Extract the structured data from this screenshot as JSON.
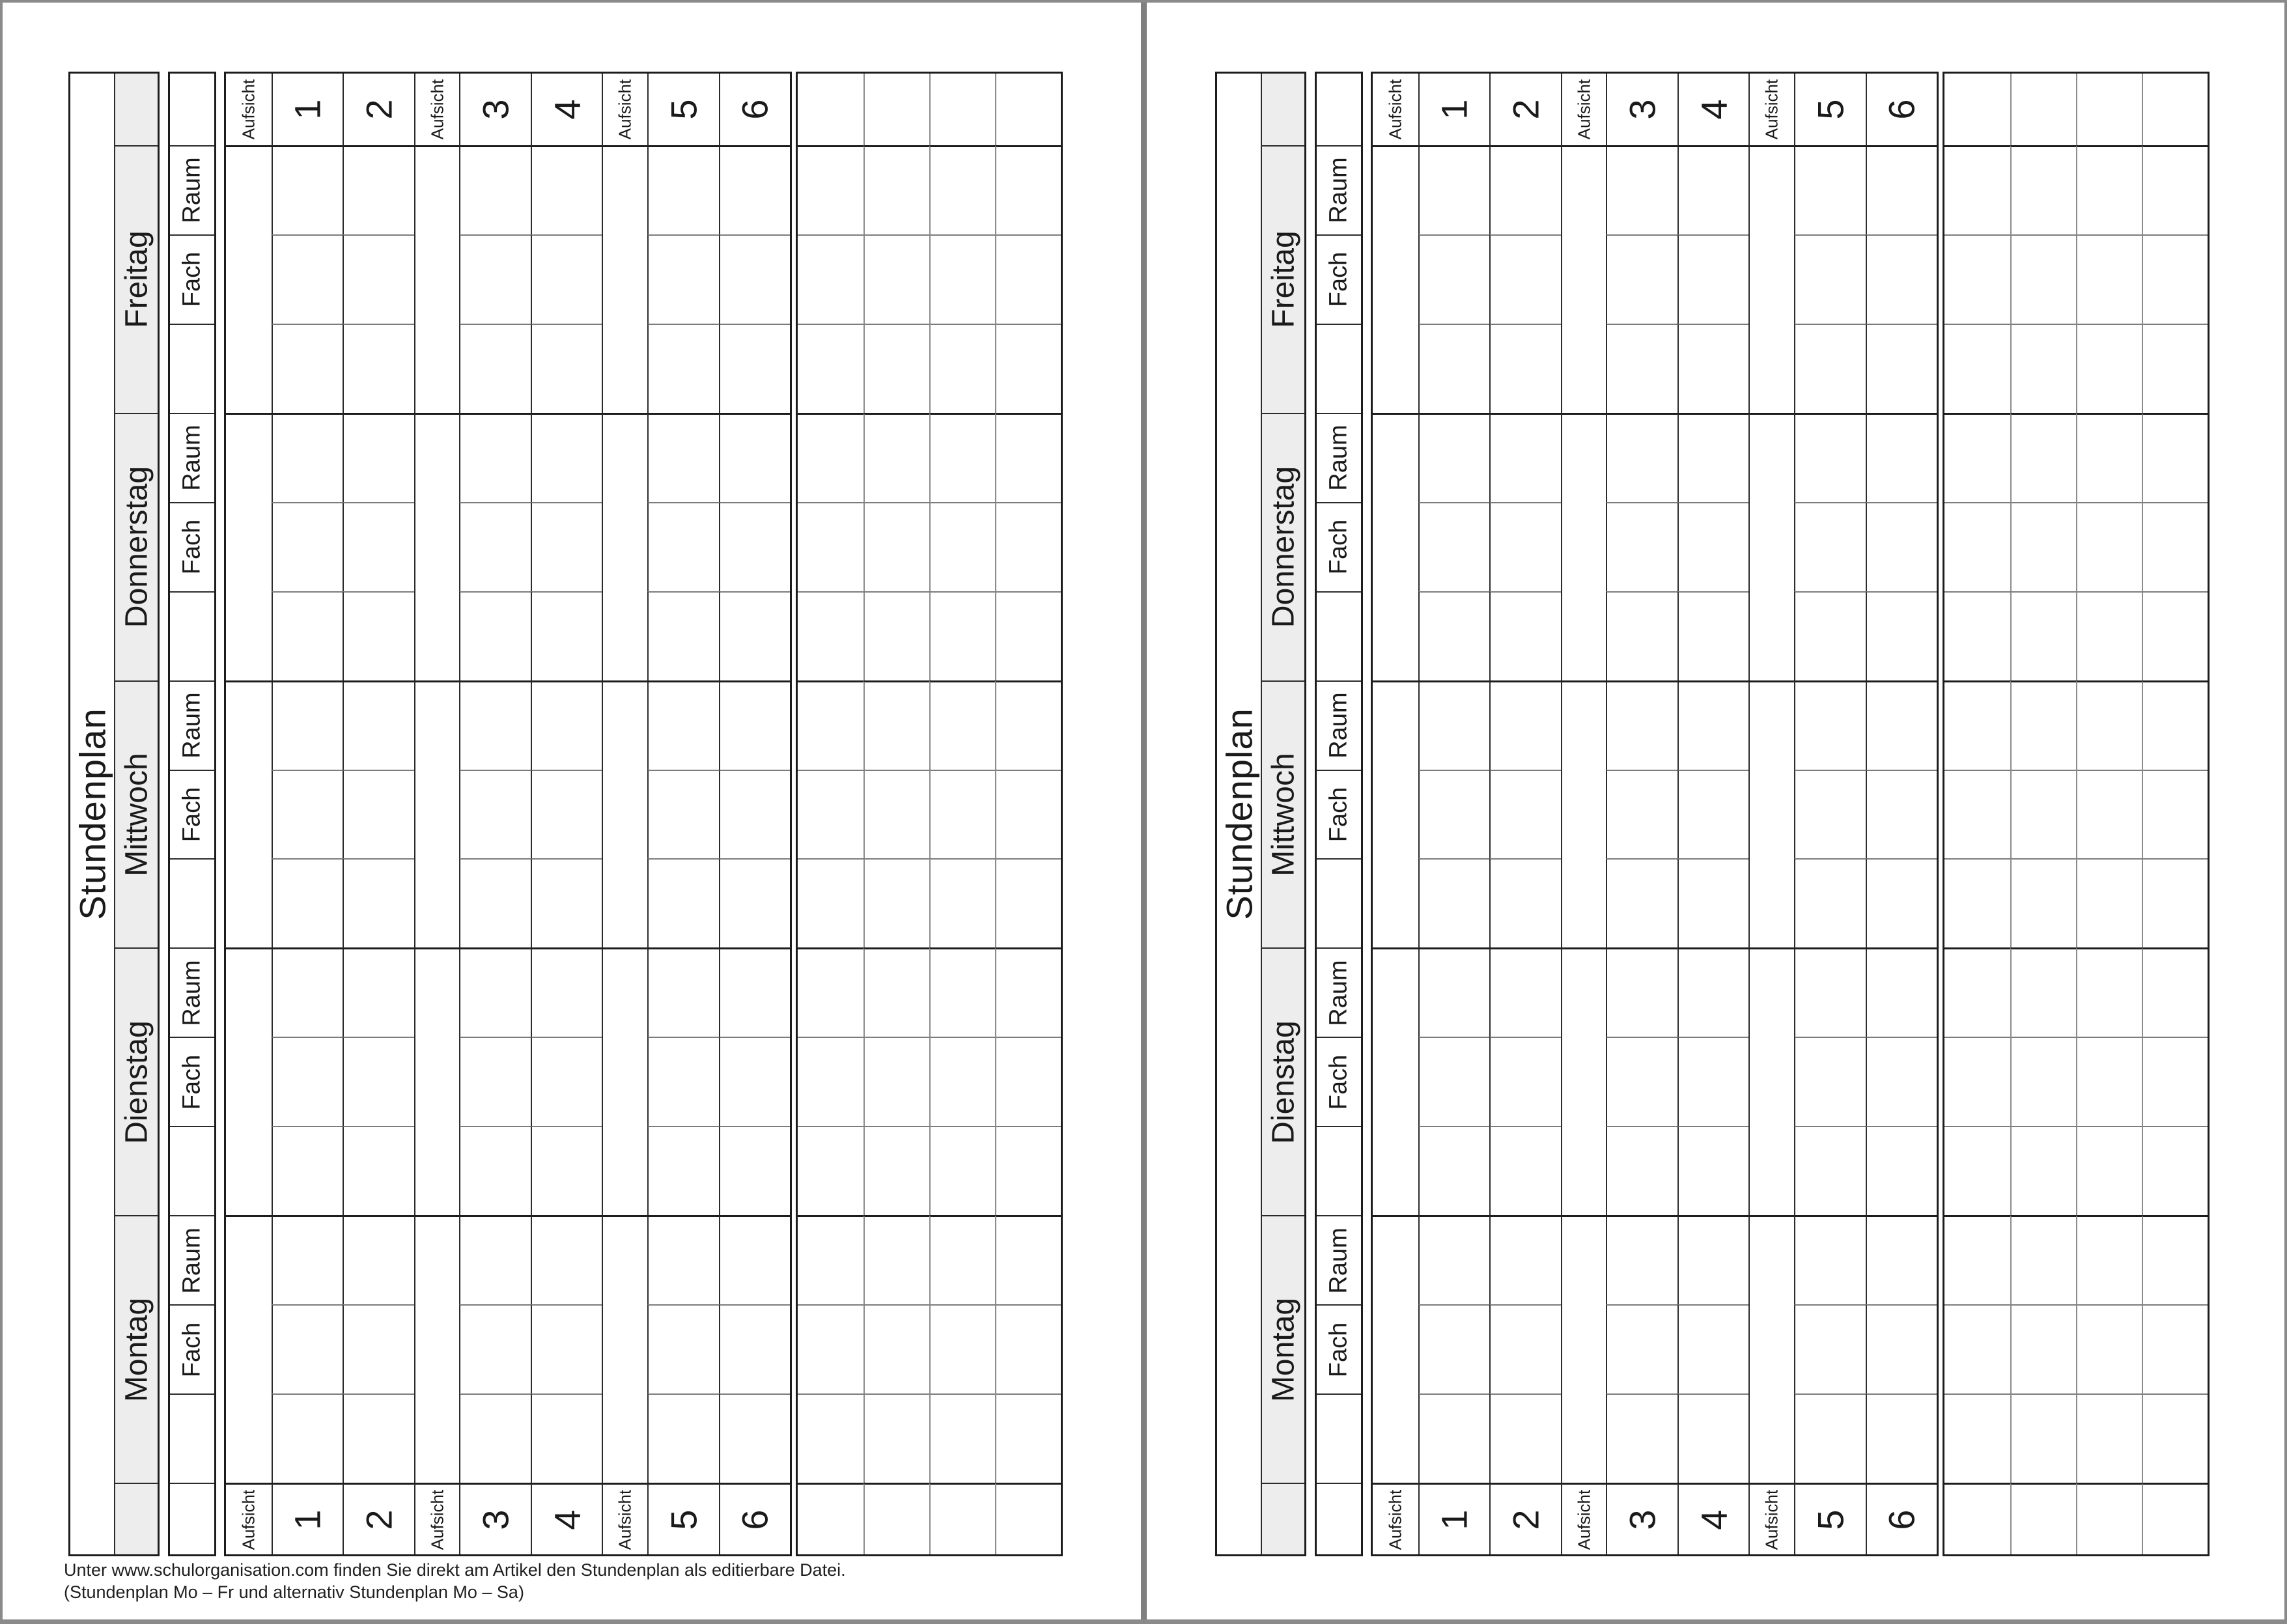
{
  "document": {
    "title": "Stundenplan",
    "days": [
      "Freitag",
      "Donnerstag",
      "Mittwoch",
      "Dienstag",
      "Montag"
    ],
    "sub_headers": {
      "raum": "Raum",
      "fach": "Fach"
    },
    "period_labels": [
      "Aufsicht",
      "1",
      "2",
      "Aufsicht",
      "3",
      "4",
      "Aufsicht",
      "5",
      "6"
    ],
    "footer": {
      "line1": "Unter www.schulorganisation.com finden Sie direkt am Artikel den Stundenplan als editierbare Datei.",
      "line2": "(Stundenplan Mo – Fr und alternativ Stundenplan Mo – Sa)"
    },
    "pages": [
      {
        "name": "page-left",
        "has_footer": true
      },
      {
        "name": "page-right",
        "has_footer": false
      }
    ],
    "colors": {
      "day_header_bg": "#ededed",
      "line_strong": "#1c1c1c",
      "line_medium": "#2b2b2b",
      "line_light": "#8c8c8c",
      "frame": "#8a8a8a",
      "divider": "#7f7f7f",
      "text": "#1a1a1a"
    }
  }
}
